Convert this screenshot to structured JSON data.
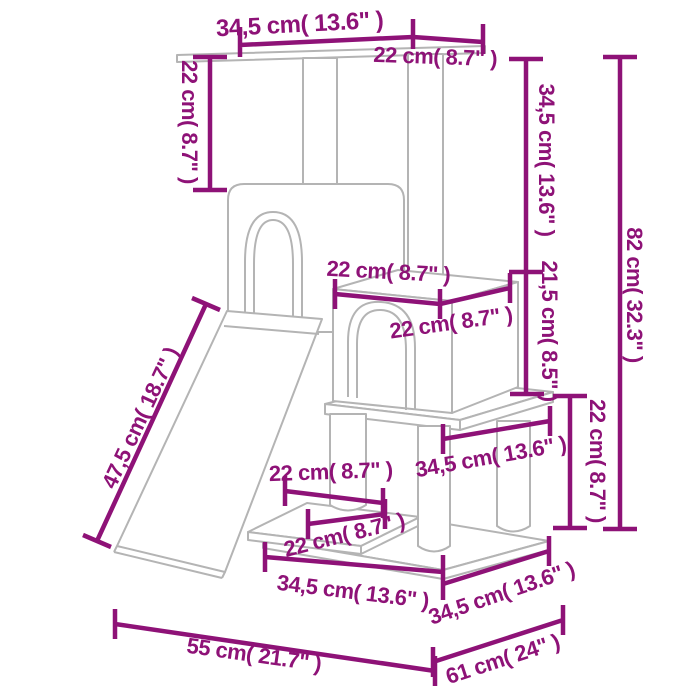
{
  "diagram": {
    "subject": "cat-tree-with-scratching-posts-dimension-diagram",
    "units": "cm / inches"
  },
  "colors": {
    "dimension_annotation": "#8E1277",
    "drawing_outline": "#B4B4B4",
    "background": "#FFFFFF"
  },
  "dimensions": {
    "top_width": {
      "label": "34,5 cm( 13.6\" )"
    },
    "top_depth": {
      "label": "22 cm( 8.7\" )"
    },
    "upper_post_height": {
      "label": "22 cm( 8.7\" )"
    },
    "right_upper_height": {
      "label": "34,5 cm( 13.6\" )"
    },
    "right_mid_height": {
      "label": "21,5 cm( 8.5\" )"
    },
    "right_lower_height": {
      "label": "22 cm( 8.7\" )"
    },
    "total_height": {
      "label": "82 cm( 32.3\" )"
    },
    "ramp_length": {
      "label": "47,5 cm( 18.7\" )"
    },
    "condo_width": {
      "label": "22 cm( 8.7\" )"
    },
    "condo_depth": {
      "label": "22 cm( 8.7\" )"
    },
    "platform_width": {
      "label": "34,5 cm( 13.6\" )"
    },
    "step_depth": {
      "label": "22 cm( 8.7\" )"
    },
    "step_width": {
      "label": "22 cm( 8.7\" )"
    },
    "base_width": {
      "label": "34,5 cm( 13.6\" )"
    },
    "base_depth": {
      "label": "34,5 cm( 13.6\" )"
    },
    "floor_width": {
      "label": "55 cm( 21.7\" )"
    },
    "floor_depth": {
      "label": "61 cm( 24\" )"
    }
  }
}
